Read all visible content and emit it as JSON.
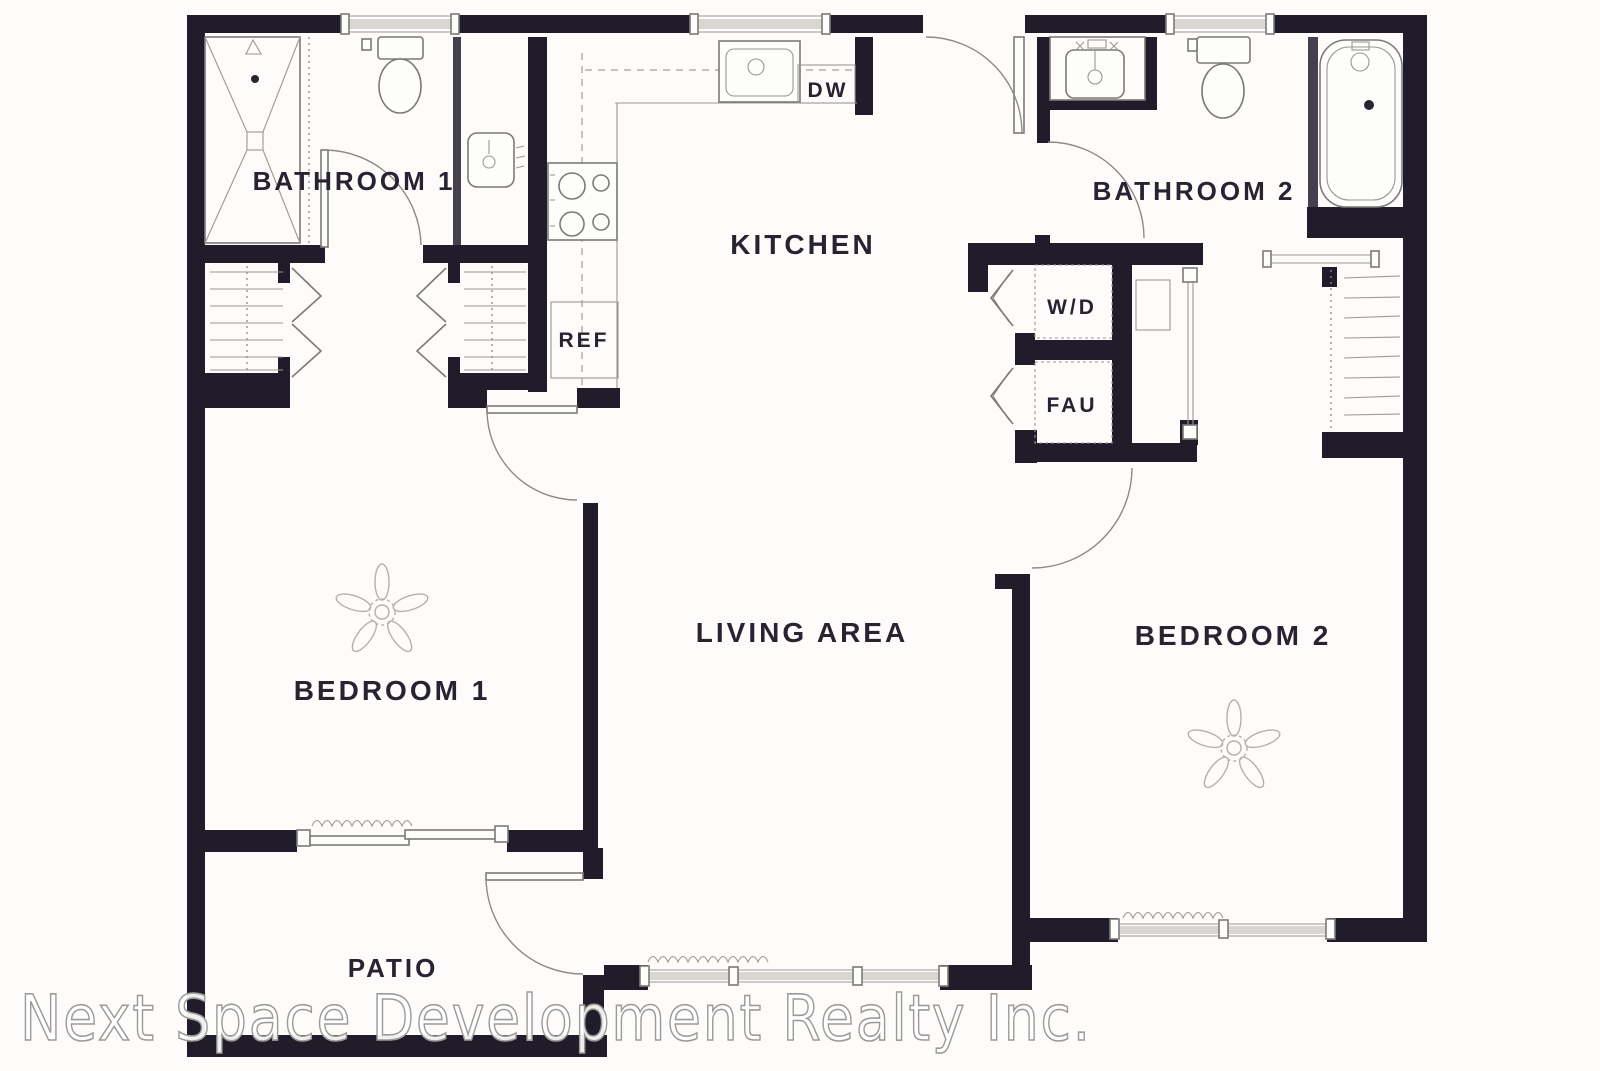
{
  "floorplan": {
    "type": "apartment-floor-plan",
    "wall_color": "#211c29",
    "line_color": "#7d7a78",
    "label_color": "#282331",
    "background": "#fdfcfa",
    "rooms": [
      {
        "id": "bathroom-1",
        "text": "BATHROOM 1",
        "x": 354,
        "y": 190,
        "size": 26
      },
      {
        "id": "kitchen",
        "text": "KITCHEN",
        "x": 803,
        "y": 254,
        "size": 28
      },
      {
        "id": "bathroom-2",
        "text": "BATHROOM 2",
        "x": 1194,
        "y": 200,
        "size": 26
      },
      {
        "id": "living-area",
        "text": "LIVING AREA",
        "x": 802,
        "y": 642,
        "size": 28
      },
      {
        "id": "bedroom-1",
        "text": "BEDROOM 1",
        "x": 392,
        "y": 700,
        "size": 28
      },
      {
        "id": "bedroom-2",
        "text": "BEDROOM 2",
        "x": 1233,
        "y": 645,
        "size": 28
      },
      {
        "id": "patio",
        "text": "PATIO",
        "x": 393,
        "y": 977,
        "size": 26
      },
      {
        "id": "washer-dryer",
        "text": "W/D",
        "x": 1072,
        "y": 314,
        "size": 21
      },
      {
        "id": "fau",
        "text": "FAU",
        "x": 1072,
        "y": 412,
        "size": 21
      },
      {
        "id": "refrigerator",
        "text": "REF",
        "x": 584,
        "y": 347,
        "size": 21
      },
      {
        "id": "dishwasher",
        "text": "DW",
        "x": 828,
        "y": 97,
        "size": 21
      }
    ],
    "fixtures": [
      "shower",
      "toilet",
      "vanity-sink",
      "closet",
      "kitchen-sink",
      "stove",
      "refrigerator",
      "dishwasher",
      "washer-dryer",
      "fau",
      "bathtub",
      "ceiling-fan",
      "sliding-glass-door",
      "window"
    ],
    "watermark": {
      "text": "Next Space Development Realty Inc."
    }
  }
}
